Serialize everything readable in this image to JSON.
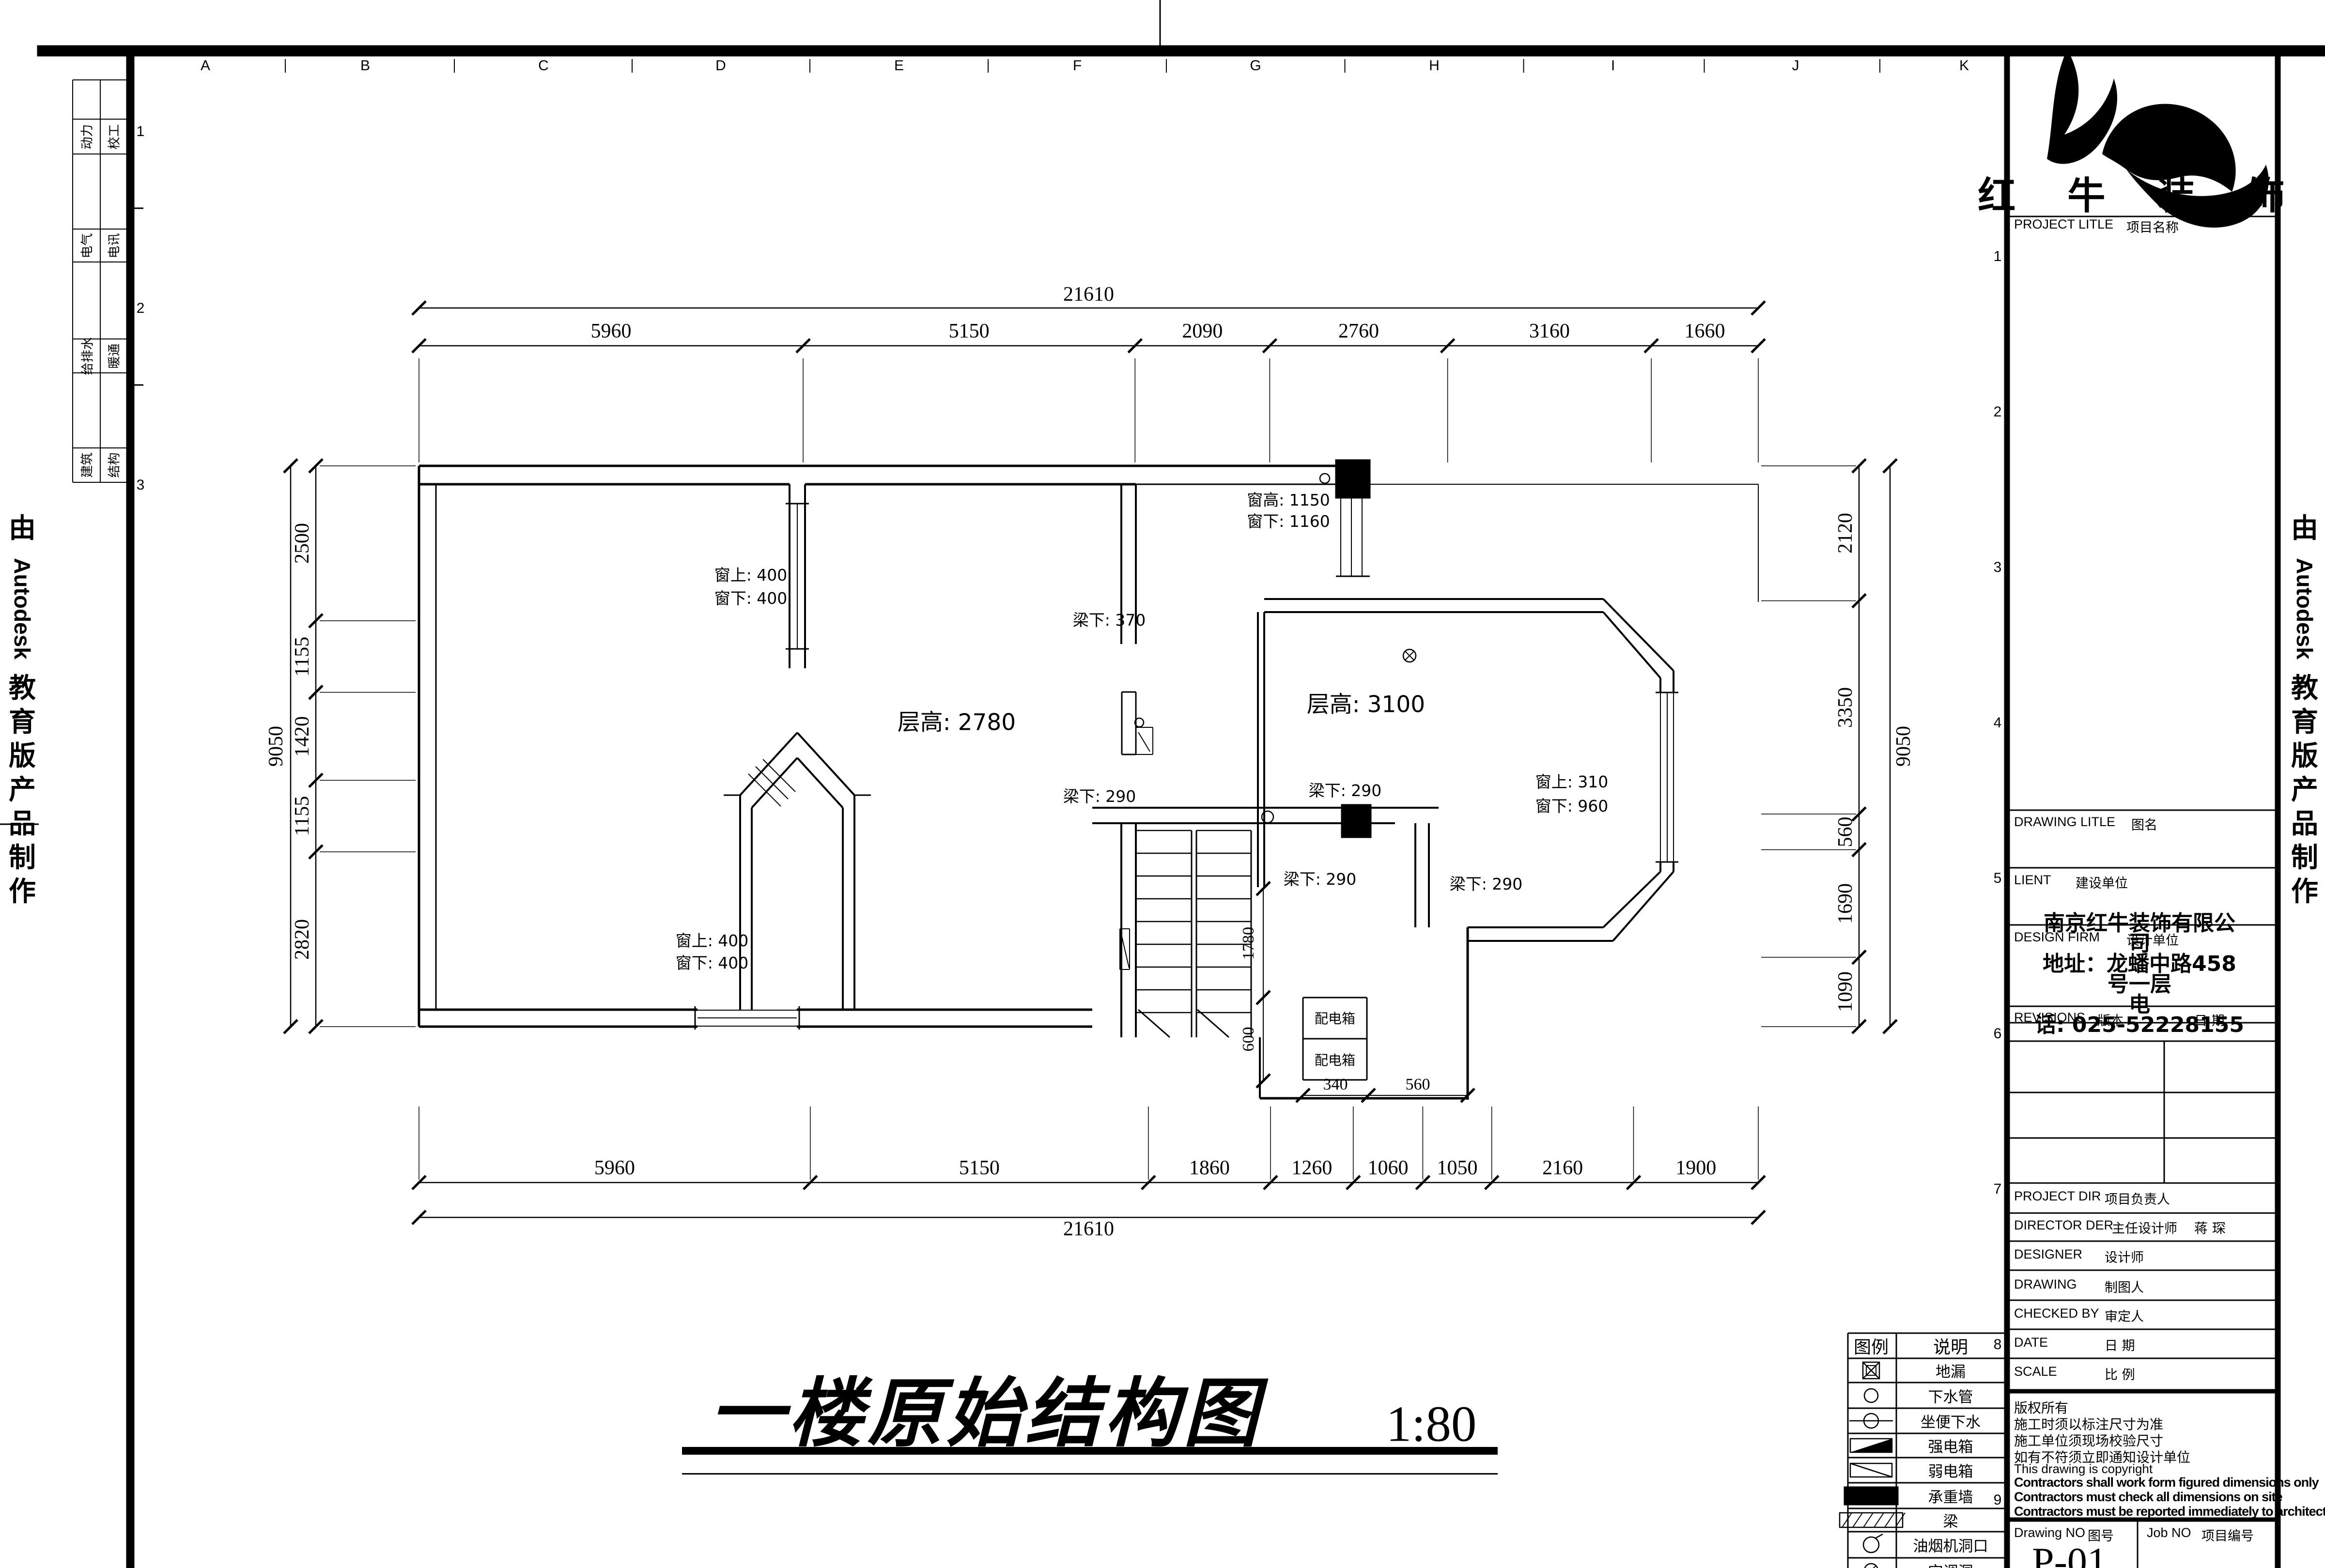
{
  "page": {
    "bg": "#ffffff",
    "ink": "#000000"
  },
  "watermark": {
    "parts": [
      "由",
      "Autodesk",
      "教",
      "育",
      "版",
      "产",
      "品",
      "制",
      "作"
    ]
  },
  "frame": {
    "top_letters": [
      "A",
      "B",
      "C",
      "D",
      "E",
      "F",
      "G",
      "H",
      "I",
      "J",
      "K"
    ],
    "left_numbers": [
      "1",
      "2",
      "3"
    ],
    "right_numbers": [
      "1",
      "2",
      "3",
      "4",
      "5",
      "6",
      "7",
      "8",
      "9"
    ],
    "discipline_strip": {
      "col1": [
        "动力",
        "电气",
        "给排水",
        "建筑"
      ],
      "col2": [
        "校工",
        "电讯",
        "暖通",
        "结构"
      ]
    }
  },
  "drawing_title": {
    "text": "一楼原始结构图",
    "scale": "1:80"
  },
  "dimensions": {
    "top": {
      "total": "21610",
      "segments": [
        "5960",
        "5150",
        "2090",
        "2760",
        "3160",
        "1660"
      ]
    },
    "bottom": {
      "total": "21610",
      "segments": [
        "5960",
        "5150",
        "1860",
        "1260",
        "1060",
        "1050",
        "2160",
        "1900"
      ]
    },
    "left": {
      "total": "9050",
      "segments": [
        "2500",
        "1155",
        "1420",
        "1155",
        "2820"
      ]
    },
    "right": {
      "total": "9050",
      "segments": [
        "2120",
        "3350",
        "560",
        "1690",
        "1090"
      ]
    },
    "detail": {
      "v1": "1780",
      "v2": "600",
      "h1": "340",
      "h2": "560"
    }
  },
  "plan_annotations": [
    {
      "id": "a1",
      "text": "窗高: 1150"
    },
    {
      "id": "a2",
      "text": "窗下: 1160"
    },
    {
      "id": "a3",
      "text": "窗上: 400"
    },
    {
      "id": "a4",
      "text": "窗下: 400"
    },
    {
      "id": "a5",
      "text": "梁下: 370"
    },
    {
      "id": "a6",
      "text": "层高: 2780"
    },
    {
      "id": "a7",
      "text": "层高: 3100"
    },
    {
      "id": "a8",
      "text": "窗上: 310"
    },
    {
      "id": "a9",
      "text": "窗下: 960"
    },
    {
      "id": "a10",
      "text": "梁下: 290"
    },
    {
      "id": "a11",
      "text": "梁下: 290"
    },
    {
      "id": "a12",
      "text": "梁下: 290"
    },
    {
      "id": "a13",
      "text": "梁下: 290"
    },
    {
      "id": "a14",
      "text": "配电箱"
    },
    {
      "id": "a15",
      "text": "配电箱"
    },
    {
      "id": "a16",
      "text": "窗上: 400"
    },
    {
      "id": "a17",
      "text": "窗下: 400"
    }
  ],
  "title_block": {
    "brand": "红 牛 装 饰",
    "rows": [
      {
        "en": "PROJECT LITLE",
        "cn": "项目名称"
      },
      {
        "en": "DRAWING LITLE",
        "cn": "图名"
      },
      {
        "en": "LIENT",
        "cn": "建设单位"
      },
      {
        "en": "DESIGN FIRM",
        "cn": "设计单位"
      },
      {
        "en": "REVISIONS",
        "cn": "版本",
        "extra": "日 期"
      },
      {
        "en": "PROJECT DIR",
        "cn": "项目负责人"
      },
      {
        "en": "DIRECTOR DER",
        "cn": "主任设计师",
        "value": "蒋 琛"
      },
      {
        "en": "DESIGNER",
        "cn": "设计师"
      },
      {
        "en": "DRAWING",
        "cn": "制图人"
      },
      {
        "en": "CHECKED BY",
        "cn": "审定人"
      },
      {
        "en": "DATE",
        "cn": "日 期"
      },
      {
        "en": "SCALE",
        "cn": "比 例"
      }
    ],
    "firm_info": [
      "南京红牛装饰有限公",
      "司",
      "地址：龙蟠中路458",
      "号一层",
      "电",
      "话: 025-52228155"
    ],
    "copyright": [
      "版权所有",
      "施工时须以标注尺寸为准",
      "施工单位须现场校验尺寸",
      "如有不符须立即通知设计单位",
      "This drawing is copyright",
      "Contractors shall work form figured dimensions only",
      "Contractors must check all dimensions on site",
      "Contractors must be reported immediately to architects"
    ],
    "drawing_no_label_en": "Drawing NO",
    "drawing_no_label_cn": "图号",
    "drawing_no": "P-01",
    "job_no_label_en": "Job NO",
    "job_no_label_cn": "项目编号"
  },
  "legend": {
    "headers": [
      "图例",
      "说明"
    ],
    "rows": [
      {
        "symbol": "floor-drain",
        "label": "地漏"
      },
      {
        "symbol": "drain-pipe",
        "label": "下水管"
      },
      {
        "symbol": "toilet-drain",
        "label": "坐便下水"
      },
      {
        "symbol": "strong-power-box",
        "label": "强电箱"
      },
      {
        "symbol": "weak-power-box",
        "label": "弱电箱"
      },
      {
        "symbol": "load-bearing-wall",
        "label": "承重墙"
      },
      {
        "symbol": "beam",
        "label": "梁"
      },
      {
        "symbol": "hood-hole",
        "label": "油烟机洞口"
      },
      {
        "symbol": "ac-hole",
        "label": "空调洞"
      }
    ]
  }
}
